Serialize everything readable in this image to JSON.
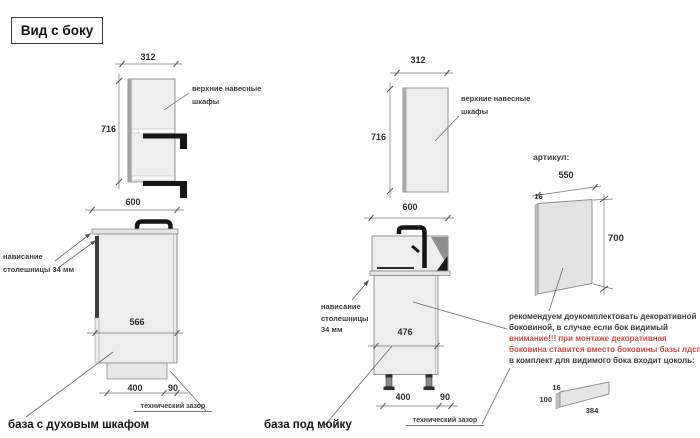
{
  "title": "Вид с боку",
  "colors": {
    "warning_red": "#c0504d",
    "text_dark": "#3b3b3b",
    "cabinet_fill": "#ededed",
    "sink_shadow": "#8f8f8f"
  },
  "wall_cabinet_left": {
    "width_mm": "312",
    "height_mm": "716",
    "label_line1": "верхние навесные",
    "label_line2": "шкафы"
  },
  "base_oven": {
    "width_mm": "600",
    "depth_mm": "566",
    "plinth_mm": "400",
    "gap_mm": "90",
    "overhang_line1": "нависание",
    "overhang_line2": "столешницы 34 мм",
    "tech_gap": "технический зазор",
    "caption": "база с духовым шкафом"
  },
  "wall_cabinet_mid": {
    "width_mm": "312",
    "height_mm": "716",
    "label_line1": "верхние навесные",
    "label_line2": "шкафы"
  },
  "base_sink": {
    "width_mm": "600",
    "depth_mm": "476",
    "plinth_mm": "400",
    "gap_mm": "90",
    "overhang_line1": "нависание",
    "overhang_line2": "столешницы",
    "overhang_line3": "34 мм",
    "tech_gap": "технический зазор",
    "caption": "база под мойку"
  },
  "side_panel": {
    "heading": "артикул:",
    "width_mm": "550",
    "thickness_mm": "16",
    "height_mm": "700"
  },
  "note": {
    "line1": "рекомендуем доукомплектовать декоративной",
    "line2": "боковиной, в случае если бок видимый",
    "line3": "внимание!!! при монтаже декоративная",
    "line4": "боковина ставится вместо боковины базы лдсп",
    "line5": "в комплект для видимого бока входит цоколь:"
  },
  "plinth_panel": {
    "thickness_mm": "16",
    "height_mm": "100",
    "length_mm": "384"
  }
}
